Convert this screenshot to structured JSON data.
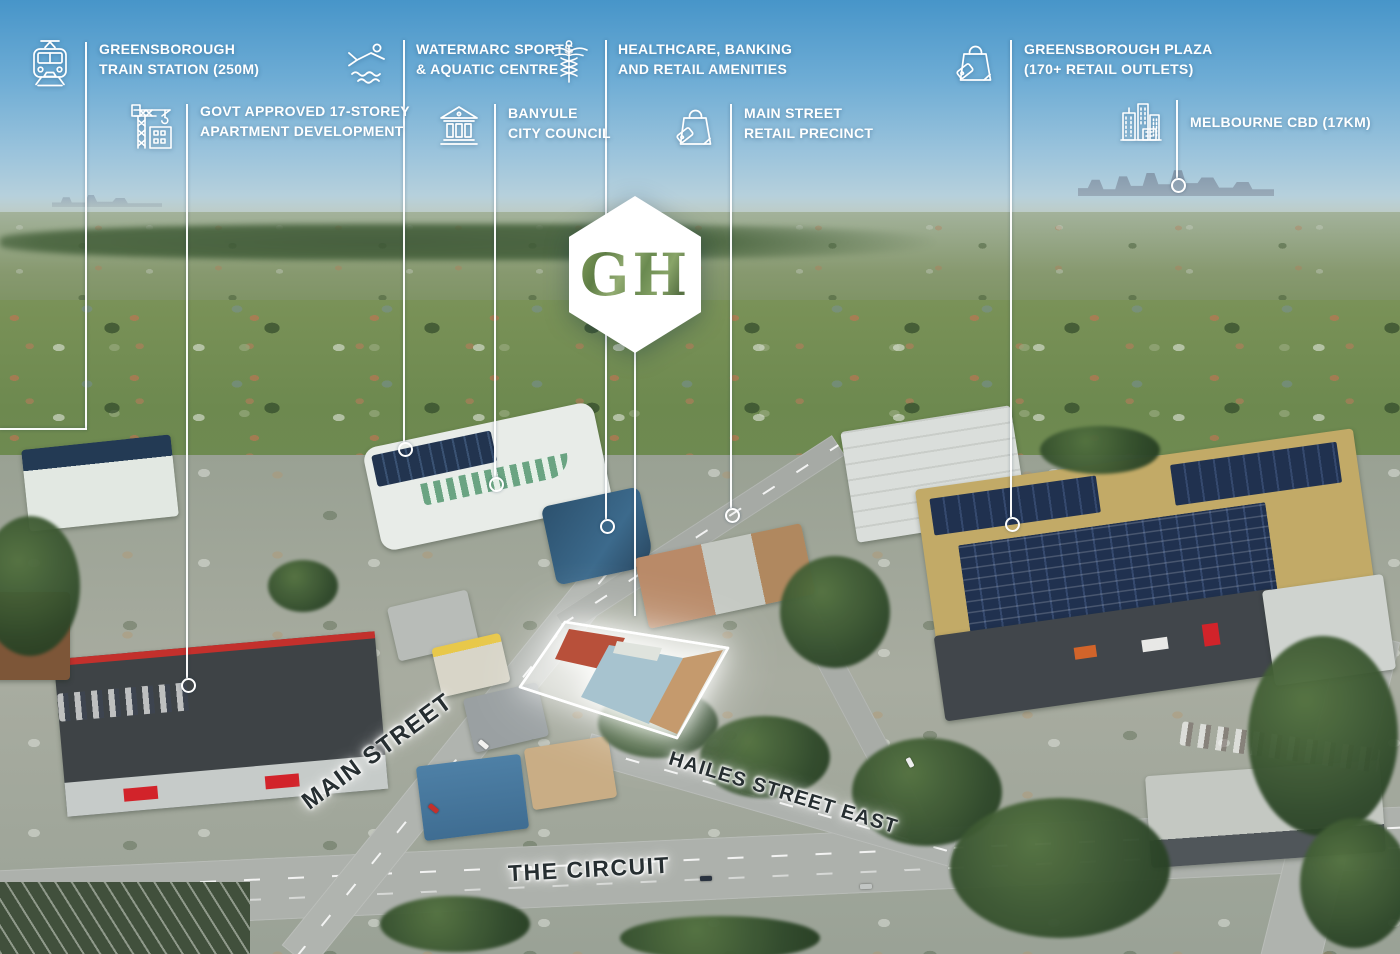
{
  "logo": {
    "text": "GH"
  },
  "callouts": [
    {
      "icon": "train-icon",
      "lines": [
        "GREENSBOROUGH",
        "TRAIN STATION (250M)"
      ]
    },
    {
      "icon": "construction-crane-icon",
      "lines": [
        "GOVT APPROVED 17-STOREY",
        "APARTMENT DEVELOPMENT"
      ]
    },
    {
      "icon": "swimmer-icon",
      "lines": [
        "WATERMARC SPORTS",
        "& AQUATIC CENTRE"
      ]
    },
    {
      "icon": "civic-building-icon",
      "lines": [
        "BANYULE",
        "CITY COUNCIL"
      ]
    },
    {
      "icon": "caduceus-icon",
      "lines": [
        "HEALTHCARE, BANKING",
        "AND RETAIL AMENITIES"
      ]
    },
    {
      "icon": "shopping-bag-icon",
      "lines": [
        "MAIN STREET",
        "RETAIL PRECINCT"
      ]
    },
    {
      "icon": "shopping-bag-icon",
      "lines": [
        "GREENSBOROUGH PLAZA",
        "(170+ RETAIL OUTLETS)"
      ]
    },
    {
      "icon": "city-skyline-icon",
      "lines": [
        "MELBOURNE CBD (17KM)"
      ]
    }
  ],
  "street_labels": [
    {
      "id": "main-street",
      "text": "MAIN STREET"
    },
    {
      "id": "hailes-street-east",
      "text": "HAILES STREET EAST"
    },
    {
      "id": "the-circuit",
      "text": "THE CIRCUIT"
    }
  ],
  "colors": {
    "callout_text": "#FFFFFF",
    "leader_line": "#FFFFFF",
    "street_text": "#262E31",
    "logo_background": "#FFFFFF",
    "logo_letters": "#6E8C52",
    "sky_top": "#4795C9",
    "highlight_glow": "#FFFFFF"
  }
}
